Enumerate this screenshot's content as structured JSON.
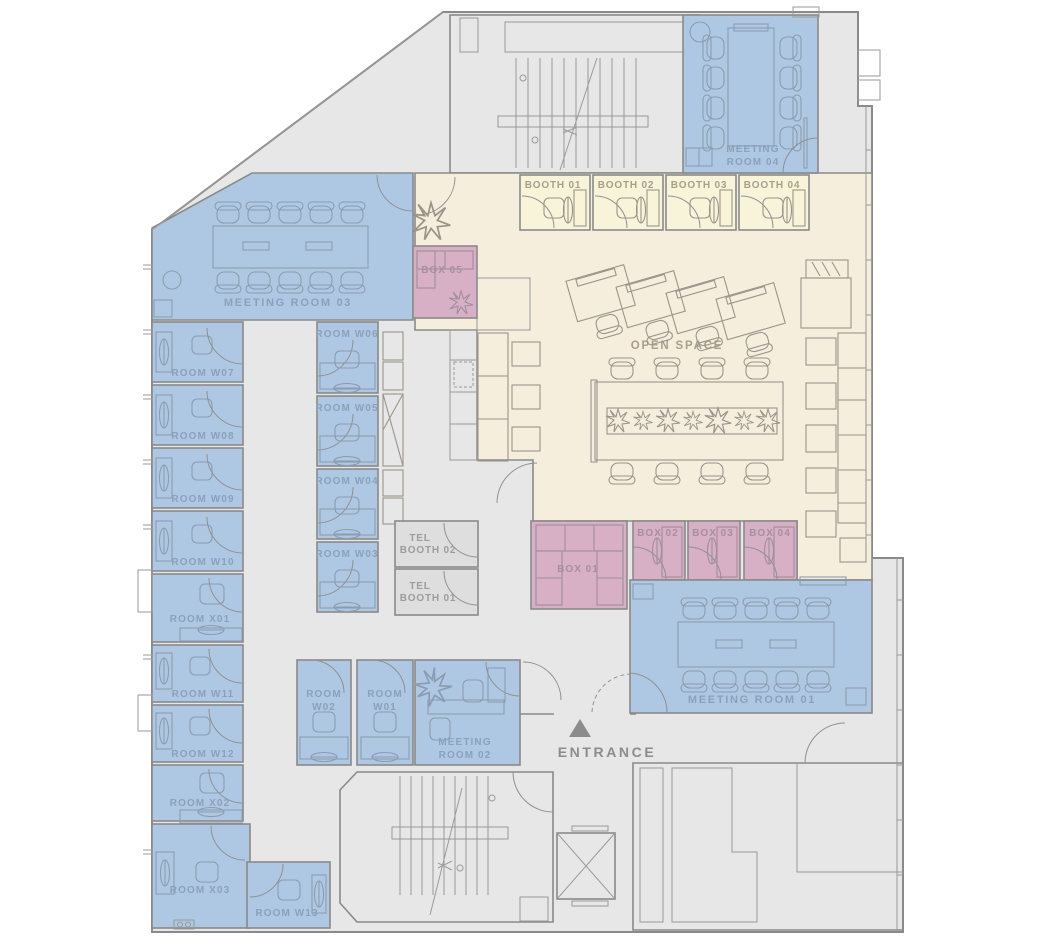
{
  "title": "Office floor plan",
  "colors": {
    "room_blue": "#aec8e3",
    "box_pink": "#d7b0c6",
    "open_cream": "#f6eedc",
    "booth_yellow": "#f7f4da",
    "corridor_gray": "#e7e7e7",
    "wall_gray": "#8a8a8a"
  },
  "labels": {
    "mr04": {
      "l1": "MEETING",
      "l2": "ROOM 04"
    },
    "booth01": "BOOTH 01",
    "booth02": "BOOTH 02",
    "booth03": "BOOTH 03",
    "booth04": "BOOTH 04",
    "mr03": "MEETING ROOM 03",
    "box05": "BOX 05",
    "open_space": "OPEN SPACE",
    "w06": "ROOM W06",
    "w05": "ROOM W05",
    "w04": "ROOM W04",
    "w03": "ROOM W03",
    "w07": "ROOM W07",
    "w08": "ROOM W08",
    "w09": "ROOM W09",
    "w10": "ROOM W10",
    "x01": "ROOM X01",
    "w11": "ROOM W11",
    "w12": "ROOM W12",
    "x02": "ROOM X02",
    "x03": "ROOM X03",
    "w13": "ROOM W13",
    "tb02": {
      "l1": "TEL",
      "l2": "BOOTH 02"
    },
    "tb01": {
      "l1": "TEL",
      "l2": "BOOTH 01"
    },
    "box01": "BOX 01",
    "box02": "BOX 02",
    "box03": "BOX 03",
    "box04": "BOX 04",
    "mr01": "MEETING ROOM 01",
    "w02": {
      "l1": "ROOM",
      "l2": "W02"
    },
    "w01": {
      "l1": "ROOM",
      "l2": "W01"
    },
    "mr02": {
      "l1": "MEETING",
      "l2": "ROOM 02"
    },
    "entrance": "ENTRANCE"
  }
}
